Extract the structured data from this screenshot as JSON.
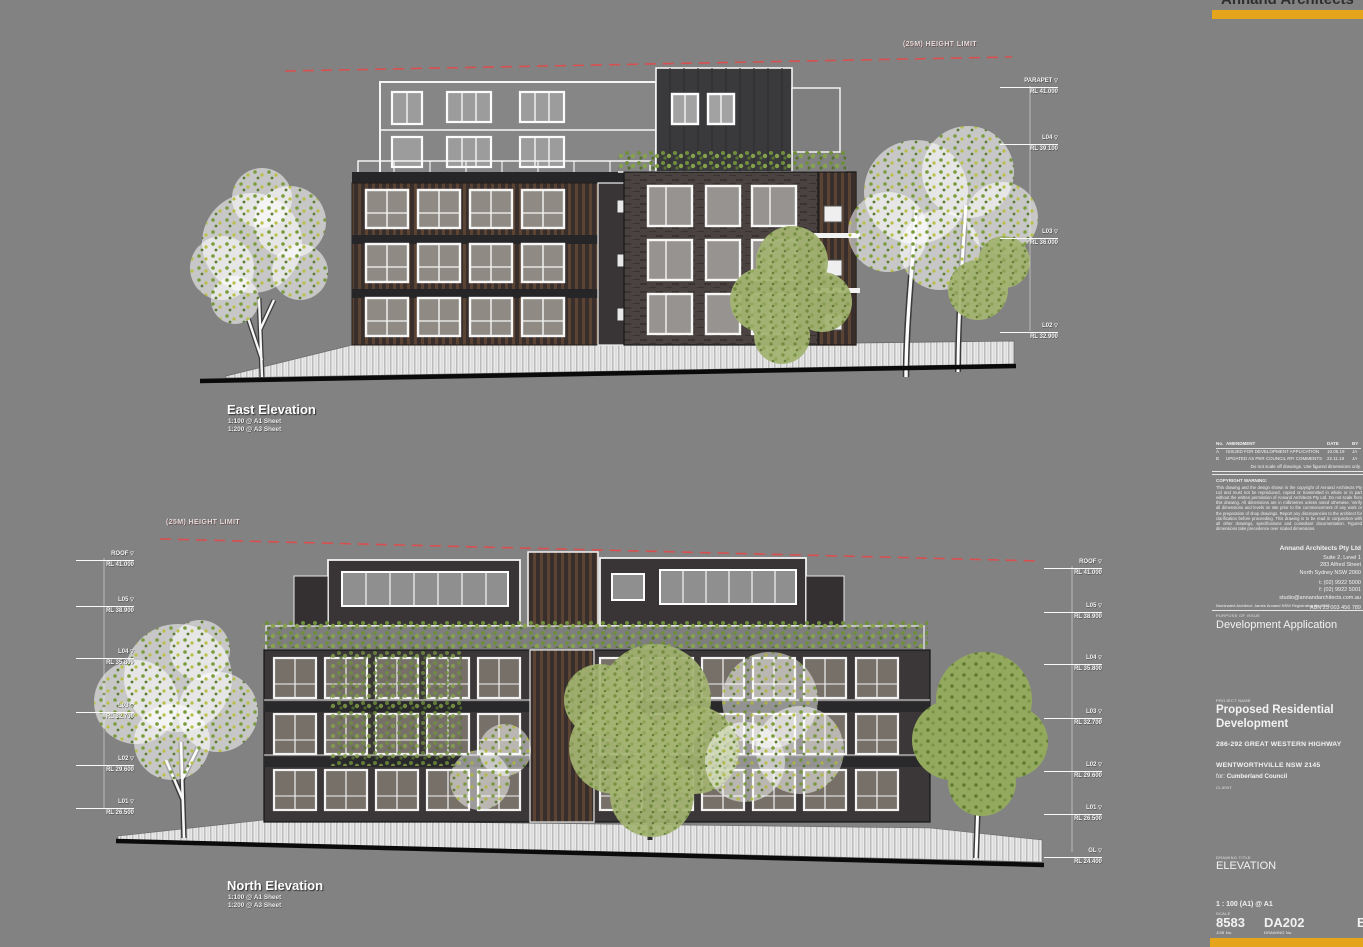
{
  "page": {
    "background": "#828282",
    "accent_gold": "#e4a51d",
    "height_limit_red": "#d94f4f"
  },
  "brand": {
    "logo_text": "Annand Architects"
  },
  "east_elevation": {
    "title": "East Elevation",
    "scale_line1": "1:100 @ A1 Sheet",
    "scale_line2": "1:200 @ A3 Sheet",
    "height_limit_label": "(25M) HEIGHT LIMIT",
    "levels": [
      {
        "name": "PARAPET",
        "rl": "RL 41.000"
      },
      {
        "name": "L04",
        "rl": "RL 39.100"
      },
      {
        "name": "L03",
        "rl": "RL 36.000"
      },
      {
        "name": "L02",
        "rl": "RL 32.900"
      }
    ]
  },
  "north_elevation": {
    "title": "North Elevation",
    "scale_line1": "1:100 @ A1 Sheet",
    "scale_line2": "1:200 @ A3 Sheet",
    "height_limit_label": "(25M) HEIGHT LIMIT",
    "levels_left": [
      {
        "name": "ROOF",
        "rl": "RL 41.000"
      },
      {
        "name": "L05",
        "rl": "RL 38.900"
      },
      {
        "name": "L04",
        "rl": "RL 35.800"
      },
      {
        "name": "L03",
        "rl": "RL 32.700"
      },
      {
        "name": "L02",
        "rl": "RL 29.600"
      },
      {
        "name": "L01",
        "rl": "RL 26.500"
      }
    ],
    "levels_right": [
      {
        "name": "ROOF",
        "rl": "RL 41.000"
      },
      {
        "name": "L05",
        "rl": "RL 38.900"
      },
      {
        "name": "L04",
        "rl": "RL 35.800"
      },
      {
        "name": "L03",
        "rl": "RL 32.700"
      },
      {
        "name": "L02",
        "rl": "RL 29.600"
      },
      {
        "name": "L01",
        "rl": "RL 26.500"
      },
      {
        "name": "GL",
        "rl": "RL 24.400"
      }
    ]
  },
  "titleblock": {
    "revisions": {
      "headers": [
        "No.",
        "AMENDMENT",
        "DATE",
        "BY"
      ],
      "rows": [
        [
          "A",
          "ISSUED FOR DEVELOPMENT APPLICATION",
          "10.05.19",
          "JA"
        ],
        [
          "B",
          "UPDATED AS PER COUNCIL RFI COMMENTS",
          "22.11.19",
          "JA"
        ]
      ]
    },
    "scale_note": "Do not scale off drawings. Use figured dimensions only.",
    "notes_heading": "COPYRIGHT WARNING:",
    "notes_text": "This drawing and the design shown is the copyright of Annand Architects Pty Ltd and must not be reproduced, copied or transmitted in whole or in part without the written permission of Annand Architects Pty Ltd. Do not scale from this drawing. All dimensions are in millimetres unless noted otherwise. Verify all dimensions and levels on site prior to the commencement of any work or the preparation of shop drawings. Report any discrepancies to the architect for clarification before proceeding. This drawing is to be read in conjunction with all other drawings, specifications and consultant documentation. Figured dimensions take precedence over scaled dimensions.",
    "practice": {
      "name": "Annand Architects Pty Ltd",
      "address1": "Suite 2, Level 1",
      "address2": "283 Alfred Street",
      "address3": "North Sydney NSW 2060",
      "tel": "t: (02) 9922 5000",
      "fax": "f: (02) 9922 5001",
      "email": "studio@annandarchitects.com.au",
      "abn": "ABN 23 003 456 789"
    },
    "nominated": "Nominated Architect: James Annand  NSW Registration No 6543",
    "status_label": "PURPOSE OF ISSUE",
    "status": "Development Application",
    "project_label": "PROJECT NAME",
    "project_line1": "Proposed Residential",
    "project_line2": "Development",
    "address_line1": "286-292 GREAT WESTERN HIGHWAY",
    "address_line2": "WENTWORTHVILLE NSW 2145",
    "client_prefix": "for:",
    "client": "Cumberland Council",
    "client_label": "CLIENT",
    "drawing_title_label": "DRAWING TITLE",
    "drawing_title": "ELEVATION",
    "scale_value": "1 : 100 (A1) @ A1",
    "scale_label": "SCALE",
    "job_number": "8583",
    "job_label": "JOB No.",
    "drawing_number": "DA202",
    "drawing_number_label": "DRAWING No.",
    "revision_letter": "B"
  }
}
